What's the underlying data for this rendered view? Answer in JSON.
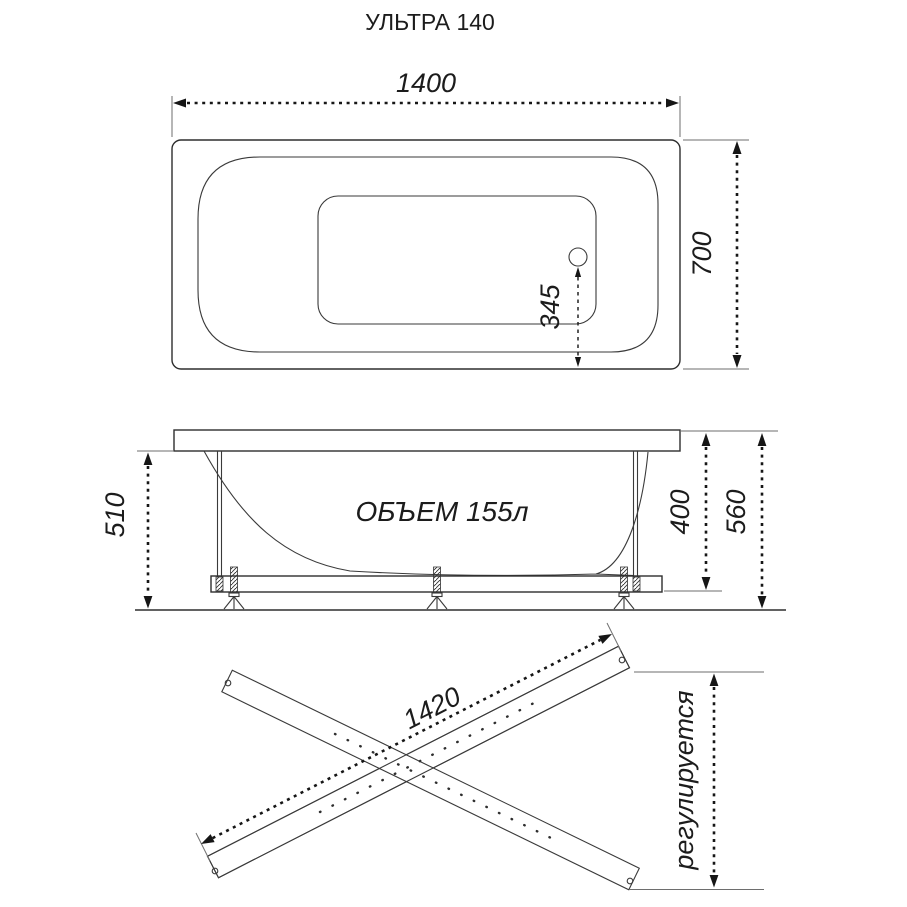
{
  "title": "УЛЬТРА 140",
  "colors": {
    "ink": "#2e2e2e",
    "dimension": "#161616",
    "background": "#ffffff"
  },
  "top_view": {
    "length": "1400",
    "width": "700",
    "drain_offset": "345"
  },
  "side_view": {
    "volume": "ОБЪЕМ 155л",
    "height_rim_to_floor": "510",
    "height_body": "400",
    "height_total": "560"
  },
  "bottom_view": {
    "rail_length": "1420",
    "adjustable": "регулируется"
  }
}
